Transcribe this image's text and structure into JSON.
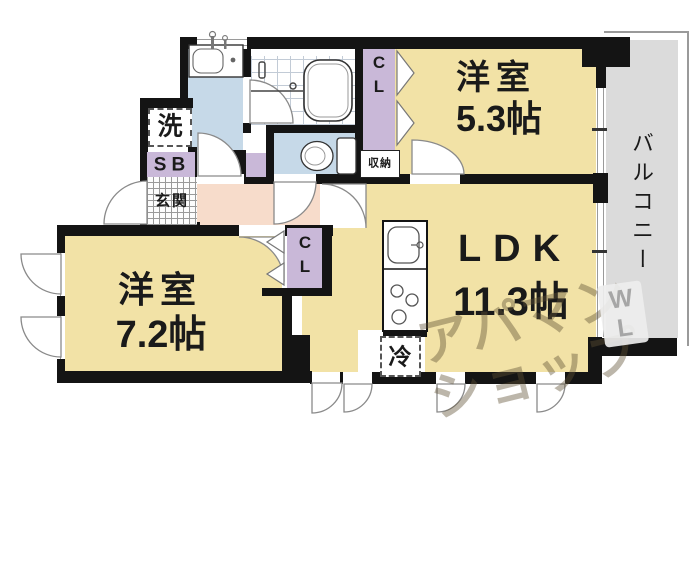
{
  "plan": {
    "rooms": {
      "bedroom1": {
        "name": "洋室",
        "size": "5.3帖"
      },
      "bedroom2": {
        "name": "洋室",
        "size": "7.2帖"
      },
      "ldk": {
        "name": "LDK",
        "size": "11.3帖"
      },
      "balcony": {
        "name": "バルコニー"
      },
      "entrance": {
        "name": "玄関"
      }
    },
    "fixtures": {
      "laundry": "洗",
      "shoe_box": "SB",
      "closet_upper": "CL",
      "closet_lower": "CL",
      "storage": "収納",
      "refrigerator": "冷"
    }
  },
  "watermark": {
    "line1": "アパマン",
    "line2": "ショップ",
    "side_line1": "W",
    "side_line2": "L"
  },
  "palette": {
    "wall": "#141414",
    "room_yellow": "#F2E2A6",
    "hall_pink": "#F7DCCB",
    "wet_blue": "#C6D9E8",
    "closet_lavender": "#C9B8D8",
    "balcony_gray": "#DBDBDB"
  }
}
